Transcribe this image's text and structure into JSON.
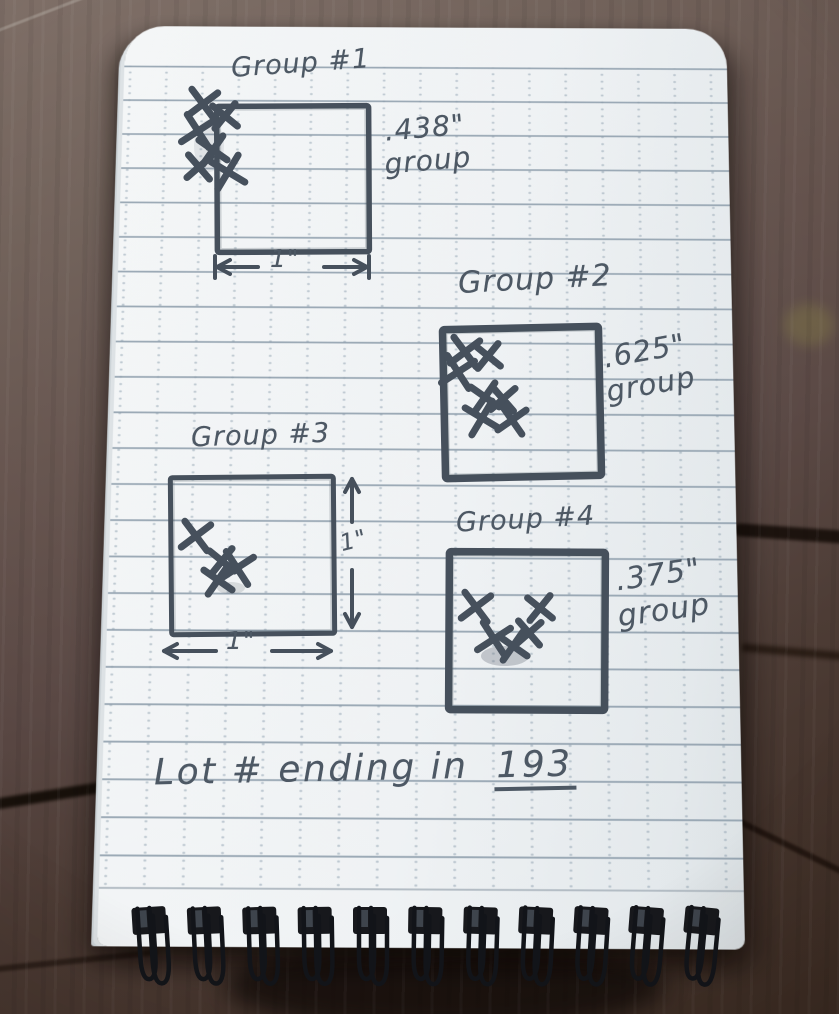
{
  "scene": {
    "setting": "spiral notepad with handwritten pencil shooting-group notes on a dark wood table",
    "colors": {
      "pencil": "#4d5864",
      "pencil_stroke": "#46505c",
      "paper": "#eff2f4",
      "rule_line": "#97a4b1",
      "wood": "#5a4841",
      "wire": "#121419"
    }
  },
  "groups": [
    {
      "title": "Group #1",
      "measurement": ".438\"",
      "measurement_word": "group",
      "dimension_bottom": "1\"",
      "square": {
        "x": 217,
        "y": 106,
        "w": 152,
        "h": 146,
        "stroke": 5.5,
        "rot": -0.3
      },
      "shots": [
        [
          203,
          104
        ],
        [
          225,
          116
        ],
        [
          198,
          131
        ],
        [
          213,
          150
        ],
        [
          199,
          167
        ],
        [
          228,
          172
        ]
      ],
      "dims": [
        {
          "orient": "h",
          "x1": 215,
          "x2": 369,
          "y": 267,
          "gap": [
            258,
            324
          ],
          "ticks": true
        }
      ]
    },
    {
      "title": "Group #2",
      "measurement": ".625\"",
      "measurement_word": "group",
      "square": {
        "x": 444,
        "y": 328,
        "w": 156,
        "h": 149,
        "stroke": 7.5,
        "rot": -1.2
      },
      "shots": [
        [
          465,
          352
        ],
        [
          488,
          356
        ],
        [
          458,
          372
        ],
        [
          485,
          397
        ],
        [
          503,
          399
        ],
        [
          482,
          418
        ],
        [
          512,
          420
        ]
      ],
      "dims": []
    },
    {
      "title": "Group #3",
      "dimension_bottom": "1\"",
      "dimension_side": "1\"",
      "square": {
        "x": 171,
        "y": 477,
        "w": 163,
        "h": 157,
        "stroke": 5,
        "rot": -0.5
      },
      "shots": [
        [
          196,
          536
        ],
        [
          222,
          561
        ],
        [
          237,
          568
        ],
        [
          218,
          580
        ]
      ],
      "dims": [
        {
          "orient": "h",
          "x1": 162,
          "x2": 333,
          "y": 651,
          "gap": [
            216,
            272
          ],
          "ticks": false
        },
        {
          "orient": "v",
          "x": 352,
          "y1": 477,
          "y2": 629,
          "gap": [
            522,
            570
          ],
          "ticks": false
        }
      ]
    },
    {
      "title": "Group #4",
      "measurement": ".375\"",
      "measurement_word": "group",
      "square": {
        "x": 449,
        "y": 552,
        "w": 156,
        "h": 158,
        "stroke": 7.5,
        "rot": 0.3
      },
      "shots": [
        [
          476,
          607
        ],
        [
          540,
          608
        ],
        [
          494,
          639
        ],
        [
          513,
          646
        ],
        [
          529,
          633
        ]
      ],
      "dims": []
    }
  ],
  "smudges": [
    {
      "cx": 505,
      "cy": 656,
      "rx": 24,
      "ry": 10,
      "opacity": 0.3
    },
    {
      "cx": 231,
      "cy": 588,
      "rx": 14,
      "ry": 6,
      "opacity": 0.18
    },
    {
      "cx": 209,
      "cy": 146,
      "rx": 15,
      "ry": 26,
      "opacity": 0.12
    }
  ],
  "footer": {
    "prefix": "Lot # ending in",
    "value": "193"
  },
  "binding": {
    "count": 11,
    "first_x": 150,
    "spacing": 55,
    "slot_top": 907
  }
}
